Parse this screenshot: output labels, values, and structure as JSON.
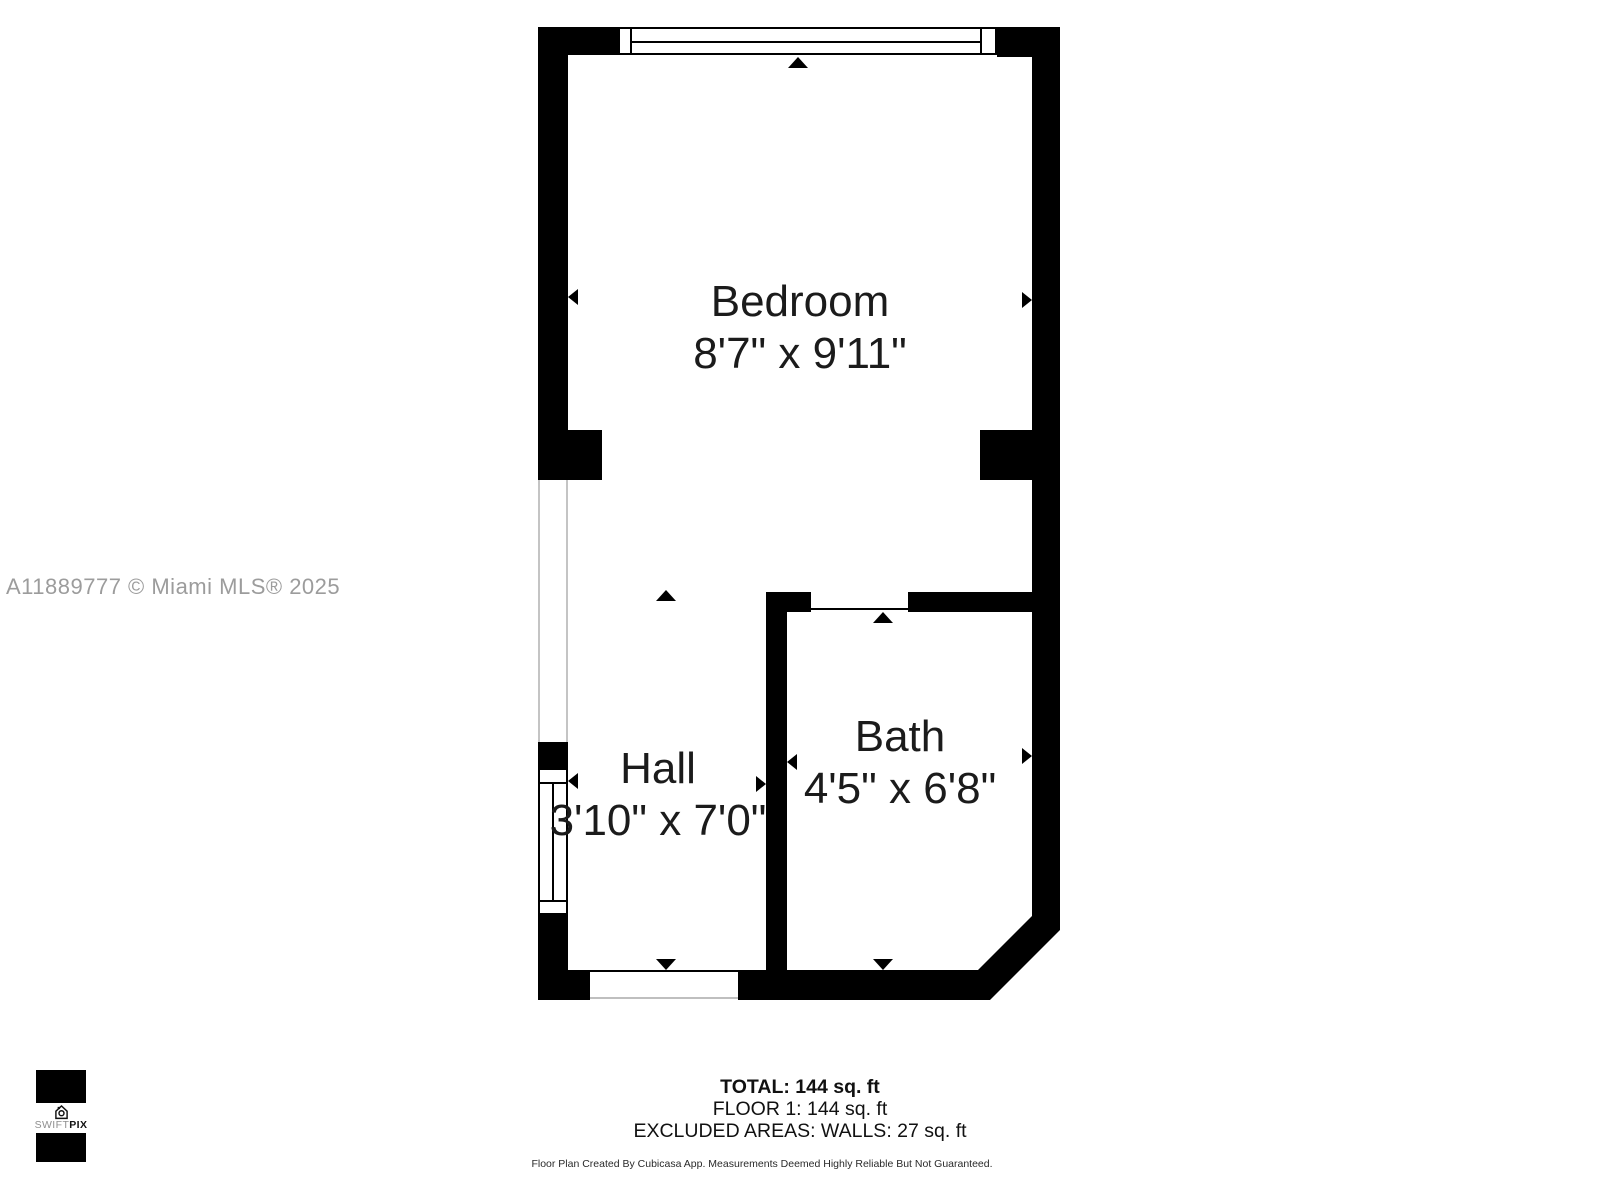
{
  "watermark": "A11889777 © Miami MLS® 2025",
  "rooms": {
    "bedroom": {
      "name": "Bedroom",
      "dimensions": "8'7\" x 9'11\""
    },
    "hall": {
      "name": "Hall",
      "dimensions": "3'10\" x 7'0\""
    },
    "bath": {
      "name": "Bath",
      "dimensions": "4'5\" x 6'8\""
    }
  },
  "summary": {
    "total": "TOTAL: 144 sq. ft",
    "floor": "FLOOR 1: 144 sq. ft",
    "excluded": "EXCLUDED AREAS: WALLS: 27 sq. ft"
  },
  "disclaimer": "Floor Plan Created By Cubicasa App. Measurements Deemed Highly Reliable But Not Guaranteed.",
  "logo": {
    "brand_light": "SWIFT",
    "brand_bold": "PIX"
  },
  "colors": {
    "wall": "#000000",
    "label": "#1b1b1b",
    "watermark": "#9c9c9c"
  }
}
